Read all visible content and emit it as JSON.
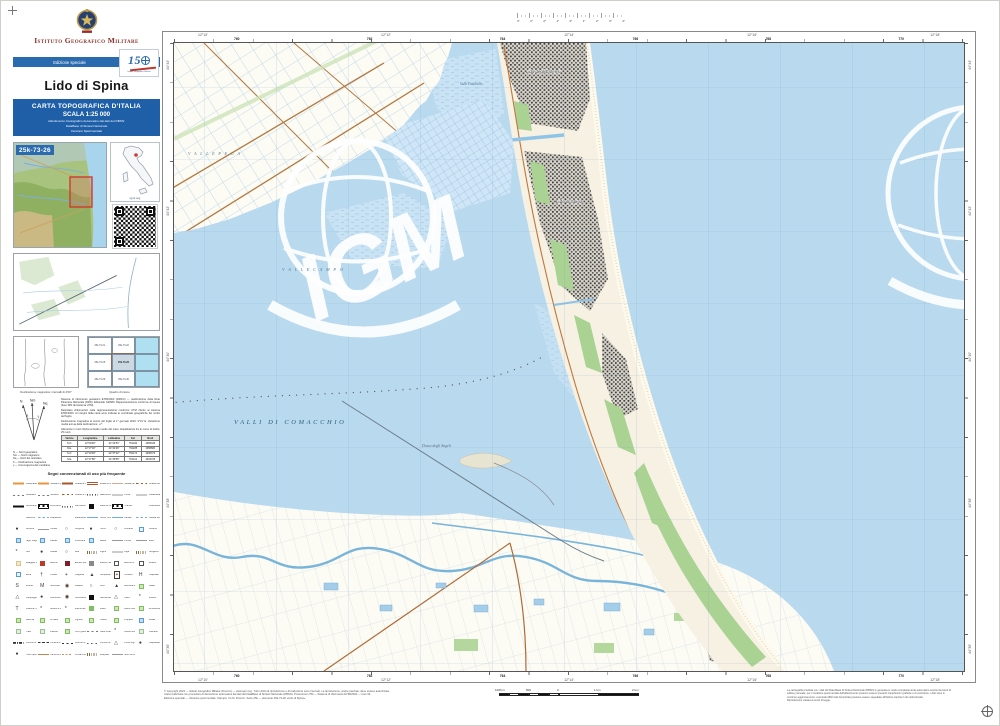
{
  "sheet": {
    "institute": "Istituto Geografico Militare",
    "edition_label": "Edizione speciale",
    "logo150_digits": [
      "1",
      "5"
    ],
    "logo150_caption": "Istituto Geografico Militare",
    "title": "Lido di Spina",
    "series_box": {
      "line1": "CARTA TOPOGRAFICA D'ITALIA",
      "line2": "SCALA 1:25 000",
      "line3": "Allestimento Cartografico Automatico dai dati del DBSN:",
      "line4": "DataBase di Sintesi Nazionale",
      "line5": "Versione Sperimentale"
    },
    "sheet_code": "25k-73-26",
    "italy_map_caption": "igmi.org"
  },
  "sidebar": {
    "declination_caption": "Declinazione magnetica: intervalli di 2′00″",
    "quadro_caption": "Quadro d'unione",
    "quadro_cells": [
      {
        "label": "25k-73-21",
        "cls": "land"
      },
      {
        "label": "25k-73-22",
        "cls": "land"
      },
      {
        "label": "",
        "cls": "sea"
      },
      {
        "label": "25k-73-25",
        "cls": "land"
      },
      {
        "label": "25k-73-26",
        "cls": "cur"
      },
      {
        "label": "",
        "cls": "sea"
      },
      {
        "label": "25k-73-29",
        "cls": "land"
      },
      {
        "label": "25k-73-30",
        "cls": "land"
      },
      {
        "label": "",
        "cls": "sea"
      }
    ],
    "north_labels": [
      "N",
      "Nm",
      "Nq",
      "δ",
      "γ"
    ],
    "north_legend": [
      "N — Nord geografico",
      "Nm — Nord magnetico",
      "Nq — Nord del reticolato",
      "δ — Declinazione magnetica",
      "γ — Convergenza del meridiano"
    ],
    "notes": [
      "Sistema di riferimento geodetico ETRF2000 (2008.0) — realizzazione della Rete Dinamica Nazionale (RDN). Ellissoide GRS80. Rappresentazione conforme di Gauss (fuso 33N del sistema UTM).",
      "Reticolato chilometrico nella rappresentazione conforme UTM riferito al sistema ETRF2000. Ai margini della carta sono indicate le coordinate geografiche dei vertici del foglio.",
      "Declinazione magnetica al centro del foglio al 1° gennaio 2023: 3°41′ E. Variazione media annua della declinazione: +7′.",
      "Altimetria in metri riferita al livello medio del mare. Equidistanza fra le curve di livello: 25 metri."
    ],
    "vertex_table": {
      "headers": [
        "Vertice",
        "Longitudine",
        "Latitudine",
        "Est",
        "Nord"
      ],
      "rows": [
        {
          "v": "N.O.",
          "lon": "12°09′48″",
          "lat": "44°44′53″",
          "e": "751240",
          "n": "4959345"
        },
        {
          "v": "N.E.",
          "lon": "12°17′19″",
          "lat": "44°44′26″",
          "e": "761185",
          "n": "4958680"
        },
        {
          "v": "S.O.",
          "lon": "12°10′28″",
          "lat": "44°37′22″",
          "e": "752174",
          "n": "4945373"
        },
        {
          "v": "S.E.",
          "lon": "12°17′58″",
          "lat": "44°36′55″",
          "e": "762101",
          "n": "4944708"
        }
      ]
    },
    "legend_title": "Segni convenzionali di uso più frequente",
    "legend_items": [
      {
        "l": "Autostrada",
        "c": "s-or"
      },
      {
        "l": "Strada di grande comunicaz.",
        "c": "s-or"
      },
      {
        "l": "Strada di interesse regionale",
        "c": "s-br"
      },
      {
        "l": "Strada di interesse locale",
        "c": "s-wh"
      },
      {
        "l": "Strada carrozzabile",
        "c": "s-thin"
      },
      {
        "l": "Strada campestre",
        "c": "s-dsh"
      },
      {
        "l": "Mulattiera",
        "c": "s-dshg"
      },
      {
        "l": "Sentiero",
        "c": "s-dshg"
      },
      {
        "l": "Strada in costruzione",
        "c": "s-dsh"
      },
      {
        "l": "Galleria stradale",
        "c": "s-tun"
      },
      {
        "l": "Ponte",
        "c": "s-gy"
      },
      {
        "l": "Cavalcavia",
        "c": "s-gy"
      },
      {
        "l": "Ferrovia a doppio binario",
        "c": "s-rail2"
      },
      {
        "l": "Ferrovia a semplice binario",
        "c": "s-rail"
      },
      {
        "l": "Ferrovia in galleria",
        "c": "s-tun"
      },
      {
        "l": "Stazione ferroviaria",
        "c": "b s-sqk"
      },
      {
        "l": "Tranvia",
        "c": "s-rail"
      },
      {
        "l": "Linea elettrica",
        "c": "s-pw"
      },
      {
        "l": "Teleferica",
        "c": "s-pw"
      },
      {
        "l": "Acquedotto",
        "c": "s-watd"
      },
      {
        "l": "Metanodotto",
        "c": "s-pw"
      },
      {
        "l": "Fiume, torrente",
        "c": "s-wat"
      },
      {
        "l": "Canale",
        "c": "s-wat"
      },
      {
        "l": "Canale sotterraneo",
        "c": "s-watd"
      },
      {
        "l": "Idrovora",
        "c": "g g-dot"
      },
      {
        "l": "Chiusa",
        "c": "s-gy"
      },
      {
        "l": "Sorgente",
        "c": "g g-cir"
      },
      {
        "l": "Pozzo",
        "c": "g g-dot"
      },
      {
        "l": "Fontana",
        "c": "g g-cir"
      },
      {
        "l": "Cisterna",
        "c": "b s-srr"
      },
      {
        "l": "Lago, stagno",
        "c": "b s-blu"
      },
      {
        "l": "Palude",
        "c": "b s-blu"
      },
      {
        "l": "Peschiera",
        "c": "b s-blu"
      },
      {
        "l": "Salina",
        "c": "b s-blu"
      },
      {
        "l": "Pontile",
        "c": "s-gy"
      },
      {
        "l": "Molo",
        "c": "s-gy"
      },
      {
        "l": "Faro",
        "c": "g g-ast"
      },
      {
        "l": "Fanale",
        "c": "g g-dot"
      },
      {
        "l": "Boa",
        "c": "g g-cir"
      },
      {
        "l": "Argine",
        "c": "s-lev"
      },
      {
        "l": "Diga",
        "c": "s-gy"
      },
      {
        "l": "Scogliera",
        "c": "s-lev"
      },
      {
        "l": "Spiaggia, dune",
        "c": "b s-dun"
      },
      {
        "l": "Edificio",
        "c": "b s-sqr"
      },
      {
        "l": "Edificio pubblico",
        "c": "b s-sqd"
      },
      {
        "l": "Edificio industriale",
        "c": "b s-sqg"
      },
      {
        "l": "Edificio in costruzione",
        "c": "b s-sqo"
      },
      {
        "l": "Rudere",
        "c": "b s-sqo"
      },
      {
        "l": "Serra",
        "c": "b s-srr"
      },
      {
        "l": "Chiesa",
        "c": "g g-ch"
      },
      {
        "l": "Cappella",
        "c": "g g-pl"
      },
      {
        "l": "Campanile",
        "c": "g g-tri"
      },
      {
        "l": "Cimitero",
        "c": "g g-pl gb"
      },
      {
        "l": "Ospedale",
        "c": "g g-h"
      },
      {
        "l": "Scuola",
        "c": "g g-s"
      },
      {
        "l": "Municipio",
        "c": "g g-m"
      },
      {
        "l": "Castello",
        "c": "g g-tgt"
      },
      {
        "l": "Torre",
        "c": "g g-cir"
      },
      {
        "l": "Monumento",
        "c": "g g-tri"
      },
      {
        "l": "Stadio",
        "c": "b s-grn2"
      },
      {
        "l": "Campeggio",
        "c": "g g-tro"
      },
      {
        "l": "Distributore carburanti",
        "c": "g g-dot"
      },
      {
        "l": "Centrale elettrica",
        "c": "g g-tgt"
      },
      {
        "l": "Cabina elettrica",
        "c": "b s-sqk"
      },
      {
        "l": "Cava",
        "c": "g g-tro"
      },
      {
        "l": "Miniera",
        "c": "g g-ast"
      },
      {
        "l": "Antenna, ripetitore",
        "c": "g g-t"
      },
      {
        "l": "Mulino a vento",
        "c": "g g-ast"
      },
      {
        "l": "Mulino ad acqua",
        "c": "g g-ast"
      },
      {
        "l": "Bosco",
        "c": "b s-grn"
      },
      {
        "l": "Bosco ceduo",
        "c": "b s-grn2"
      },
      {
        "l": "Rimboschimento",
        "c": "b s-grn2"
      },
      {
        "l": "Macchia",
        "c": "b s-grn2"
      },
      {
        "l": "Frutteto",
        "c": "b s-grn2"
      },
      {
        "l": "Vigneto",
        "c": "b s-grn2"
      },
      {
        "l": "Oliveto",
        "c": "b s-grn2"
      },
      {
        "l": "Pioppeto",
        "c": "b s-grn2"
      },
      {
        "l": "Risaia",
        "c": "b s-blu"
      },
      {
        "l": "Prato",
        "c": "b s-grnl"
      },
      {
        "l": "Pascolo",
        "c": "b s-grnl"
      },
      {
        "l": "Orto, giardino",
        "c": "b s-grn2"
      },
      {
        "l": "Filare di alberi",
        "c": "s-dshg"
      },
      {
        "l": "Albero isolato",
        "c": "g g-ast"
      },
      {
        "l": "Canneto",
        "c": "b s-grnl"
      },
      {
        "l": "Confine di Stato",
        "c": "s-bst"
      },
      {
        "l": "Confine di Regione",
        "c": "s-breg"
      },
      {
        "l": "Confine di Provincia",
        "c": "s-bpr"
      },
      {
        "l": "Confine di Comune",
        "c": "s-bco"
      },
      {
        "l": "Punto trigonometrico",
        "c": "g g-tro"
      },
      {
        "l": "Caposaldo di livellazione",
        "c": "g g-dot"
      },
      {
        "l": "Punto quotato",
        "c": "g g-dot"
      },
      {
        "l": "Curva di livello direttrice",
        "c": "s-cont"
      },
      {
        "l": "Curva di livello ordinaria",
        "c": "s-contd"
      },
      {
        "l": "Scarpata",
        "c": "s-lev"
      },
      {
        "l": "Muro di sostegno",
        "c": "s-gy"
      }
    ]
  },
  "map": {
    "watermark": "IGM",
    "labels": {
      "valli_di_comacchio": "VALLI DI COMACCHIO",
      "valle_campo": "V A L L E   C A M P O",
      "valle_pega": "V A L L E   P E G A",
      "valle_fattibello": "Valle Fattibello",
      "dosso_degli_angeli": "Dosso degli Angeli",
      "lido_degli_estensi": "Lido degli Estensi",
      "lido_di_spina": "Lido di Spina"
    },
    "border": {
      "top_coords": [
        "12°10′",
        "12°12′",
        "12°14′",
        "12°16′",
        "12°18′"
      ],
      "top_grid": [
        "760",
        "762",
        "764",
        "766",
        "768",
        "770"
      ],
      "bottom_coords": [
        "12°10′",
        "12°12′",
        "12°14′",
        "12°16′",
        "12°18′"
      ],
      "bottom_grid": [
        "760",
        "762",
        "764",
        "766",
        "768",
        "770"
      ],
      "left_coords": [
        "44°44′",
        "44°42′",
        "44°40′",
        "44°38′",
        "44°36′"
      ],
      "right_coords": [
        "44°44′",
        "44°42′",
        "44°40′",
        "44°38′",
        "44°36′"
      ]
    },
    "ruler_values": [
      "4°",
      "3°",
      "2°",
      "1°",
      "0°",
      "1°",
      "2°",
      "3°",
      "4°"
    ]
  },
  "footer": {
    "copyright_lines": [
      "© Copyright 2023 — Istituto Geografico Militare (Firenze) — www.igmi.org. Tutti i diritti di riproduzione e di traduzione sono riservati. La riproduzione, anche parziale, deve essere autorizzata.",
      "Carta realizzata con procedura di derivazione automatica dai dati del DataBase di Sintesi Nazionale (DBSN). Proiezione UTM — Sistema di riferimento ETRF2000 — fuso 33.",
      "Edizione speciale — Versione sperimentale. Stampa: I.G.M. Firenze. Serie 25k — elemento 25k-73-26 «Lido di Spina»."
    ],
    "scalebar_labels": [
      "1000 m",
      "500",
      "0",
      "1 km",
      "2 km"
    ],
    "note_lines": [
      "La cartografia prodotta con i dati del Data Base di Sintesi Nazionale (DBSN) è generata in modo completamente automatico senza interventi di",
      "editing manuale; per il carattere sperimentale dell'allestimento possono essere presenti imperfezioni grafiche e di vestizione. I dati sono in",
      "continuo aggiornamento: eventuali difformità riscontrate possono essere segnalate all'Istituto tramite il sito istituzionale.",
      "Riproduzione vietata ai sensi di legge."
    ]
  }
}
